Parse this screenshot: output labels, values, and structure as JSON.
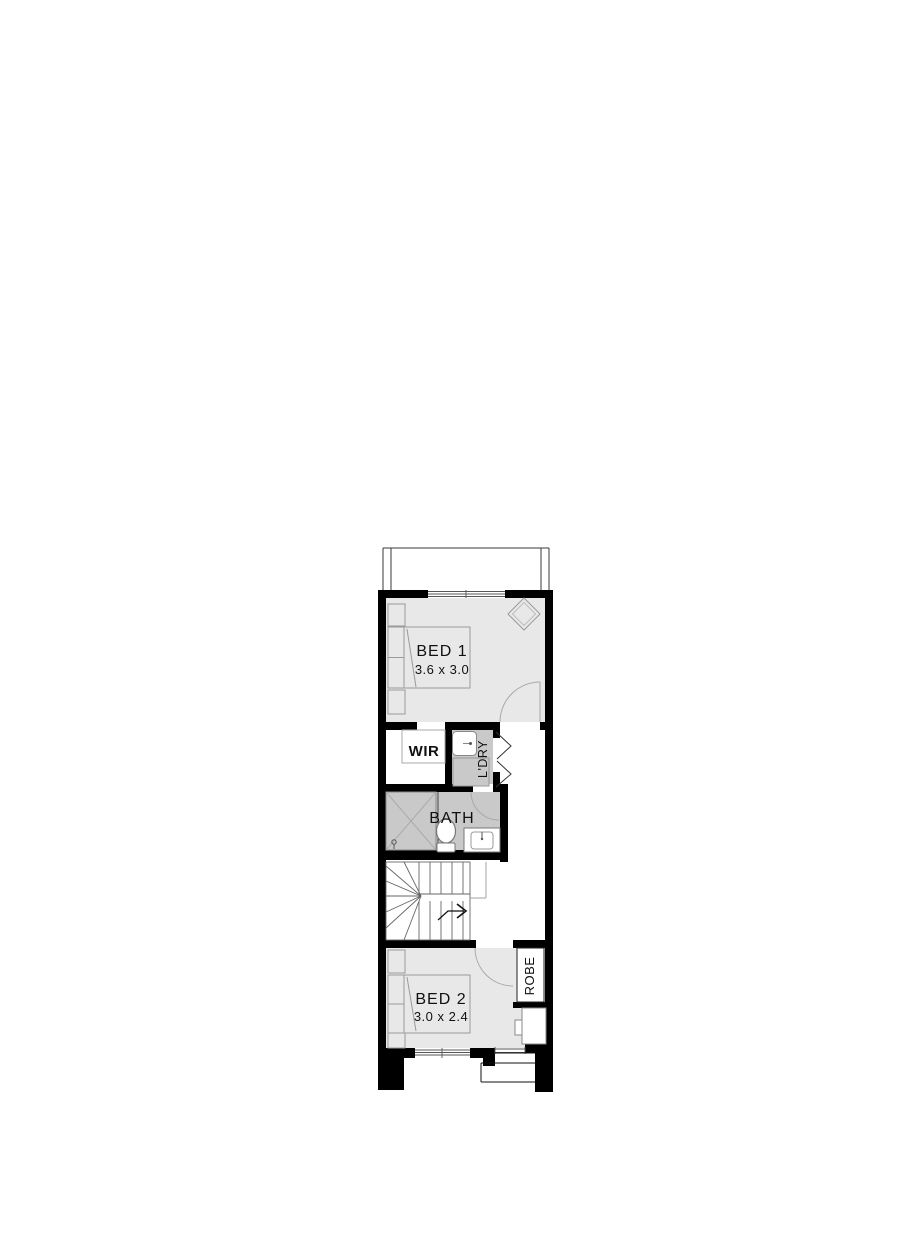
{
  "plan": {
    "type": "architectural-floor-plan",
    "rooms": {
      "bed1": {
        "name": "BED 1",
        "dims": "3.6 x 3.0"
      },
      "bed2": {
        "name": "BED 2",
        "dims": "3.0 x 2.4"
      },
      "wir": {
        "name": "WIR"
      },
      "ldry": {
        "name": "L'DRY"
      },
      "bath": {
        "name": "BATH"
      },
      "robe": {
        "name": "ROBE"
      }
    },
    "icons": [
      "double-bed",
      "bedside-table",
      "pillow",
      "ceiling-feature-diamond",
      "laundry-tub",
      "washing-machine",
      "bifold-door",
      "shower",
      "toilet",
      "vanity-basin",
      "hinged-door-arc",
      "staircase-winders",
      "stair-direction-arrow",
      "window",
      "entry-steps",
      "robe-cabinet"
    ],
    "colors": {
      "wall": "#000000",
      "room_fill": "#e8e8e8",
      "wet_area_fill": "#c9c9c9",
      "furniture_line": "#9a9a9a",
      "fixture_line": "#777777",
      "text": "#111111",
      "background": "#ffffff"
    }
  }
}
